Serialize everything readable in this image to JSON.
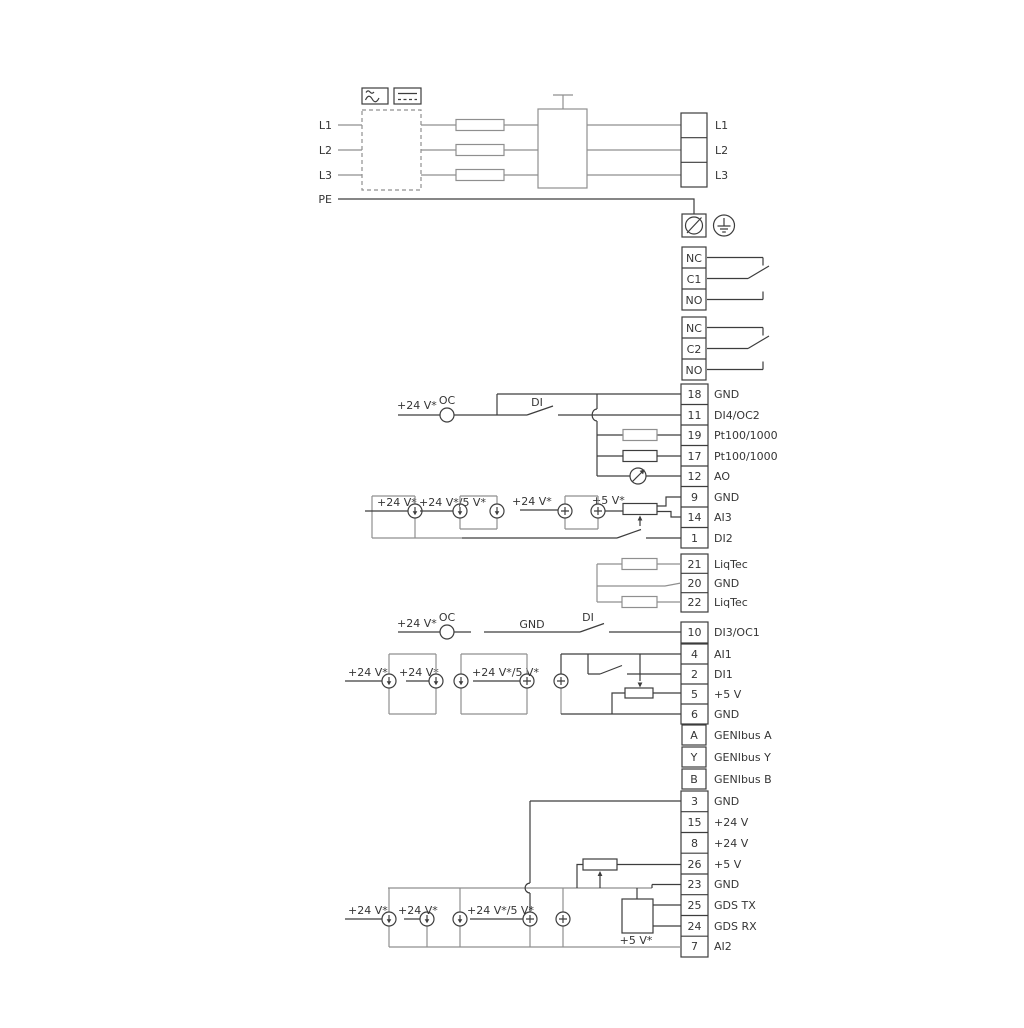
{
  "power": {
    "inputs": [
      "L1",
      "L2",
      "L3"
    ],
    "pe": "PE",
    "outputs": [
      "L1",
      "L2",
      "L3"
    ]
  },
  "relay1": {
    "rows": [
      "NC",
      "C1",
      "NO"
    ]
  },
  "relay2": {
    "rows": [
      "NC",
      "C2",
      "NO"
    ]
  },
  "block1": {
    "rows": [
      {
        "num": "18",
        "label": "GND"
      },
      {
        "num": "11",
        "label": "DI4/OC2"
      },
      {
        "num": "19",
        "label": "Pt100/1000"
      },
      {
        "num": "17",
        "label": "Pt100/1000"
      },
      {
        "num": "12",
        "label": "AO"
      },
      {
        "num": "9",
        "label": "GND"
      },
      {
        "num": "14",
        "label": "AI3"
      },
      {
        "num": "1",
        "label": "DI2"
      }
    ]
  },
  "liqtec": {
    "rows": [
      {
        "num": "21",
        "label": "LiqTec"
      },
      {
        "num": "20",
        "label": "GND"
      },
      {
        "num": "22",
        "label": "LiqTec"
      }
    ]
  },
  "block2": {
    "rows": [
      {
        "num": "10",
        "label": "DI3/OC1"
      },
      {
        "num": "4",
        "label": "AI1"
      },
      {
        "num": "2",
        "label": "DI1"
      },
      {
        "num": "5",
        "label": "+5 V"
      },
      {
        "num": "6",
        "label": "GND"
      }
    ]
  },
  "genibus": {
    "rows": [
      {
        "num": "A",
        "label": "GENIbus A"
      },
      {
        "num": "Y",
        "label": "GENIbus Y"
      },
      {
        "num": "B",
        "label": "GENIbus B"
      }
    ]
  },
  "block3": {
    "rows": [
      {
        "num": "3",
        "label": "GND"
      },
      {
        "num": "15",
        "label": "+24 V"
      },
      {
        "num": "8",
        "label": "+24 V"
      },
      {
        "num": "26",
        "label": "+5 V"
      },
      {
        "num": "23",
        "label": "GND"
      },
      {
        "num": "25",
        "label": "GDS TX"
      },
      {
        "num": "24",
        "label": "GDS RX"
      },
      {
        "num": "7",
        "label": "AI2"
      }
    ]
  },
  "ann": {
    "v24": "+24 V*",
    "v24_5": "+24 V*/5 V*",
    "v5": "+5 V*",
    "oc": "OC",
    "di": "DI",
    "gnd": "GND"
  },
  "colors": {
    "wire_gray": "#8f8f8f",
    "wire_dark": "#3d3d3d",
    "text": "#353535",
    "background": "#ffffff"
  }
}
